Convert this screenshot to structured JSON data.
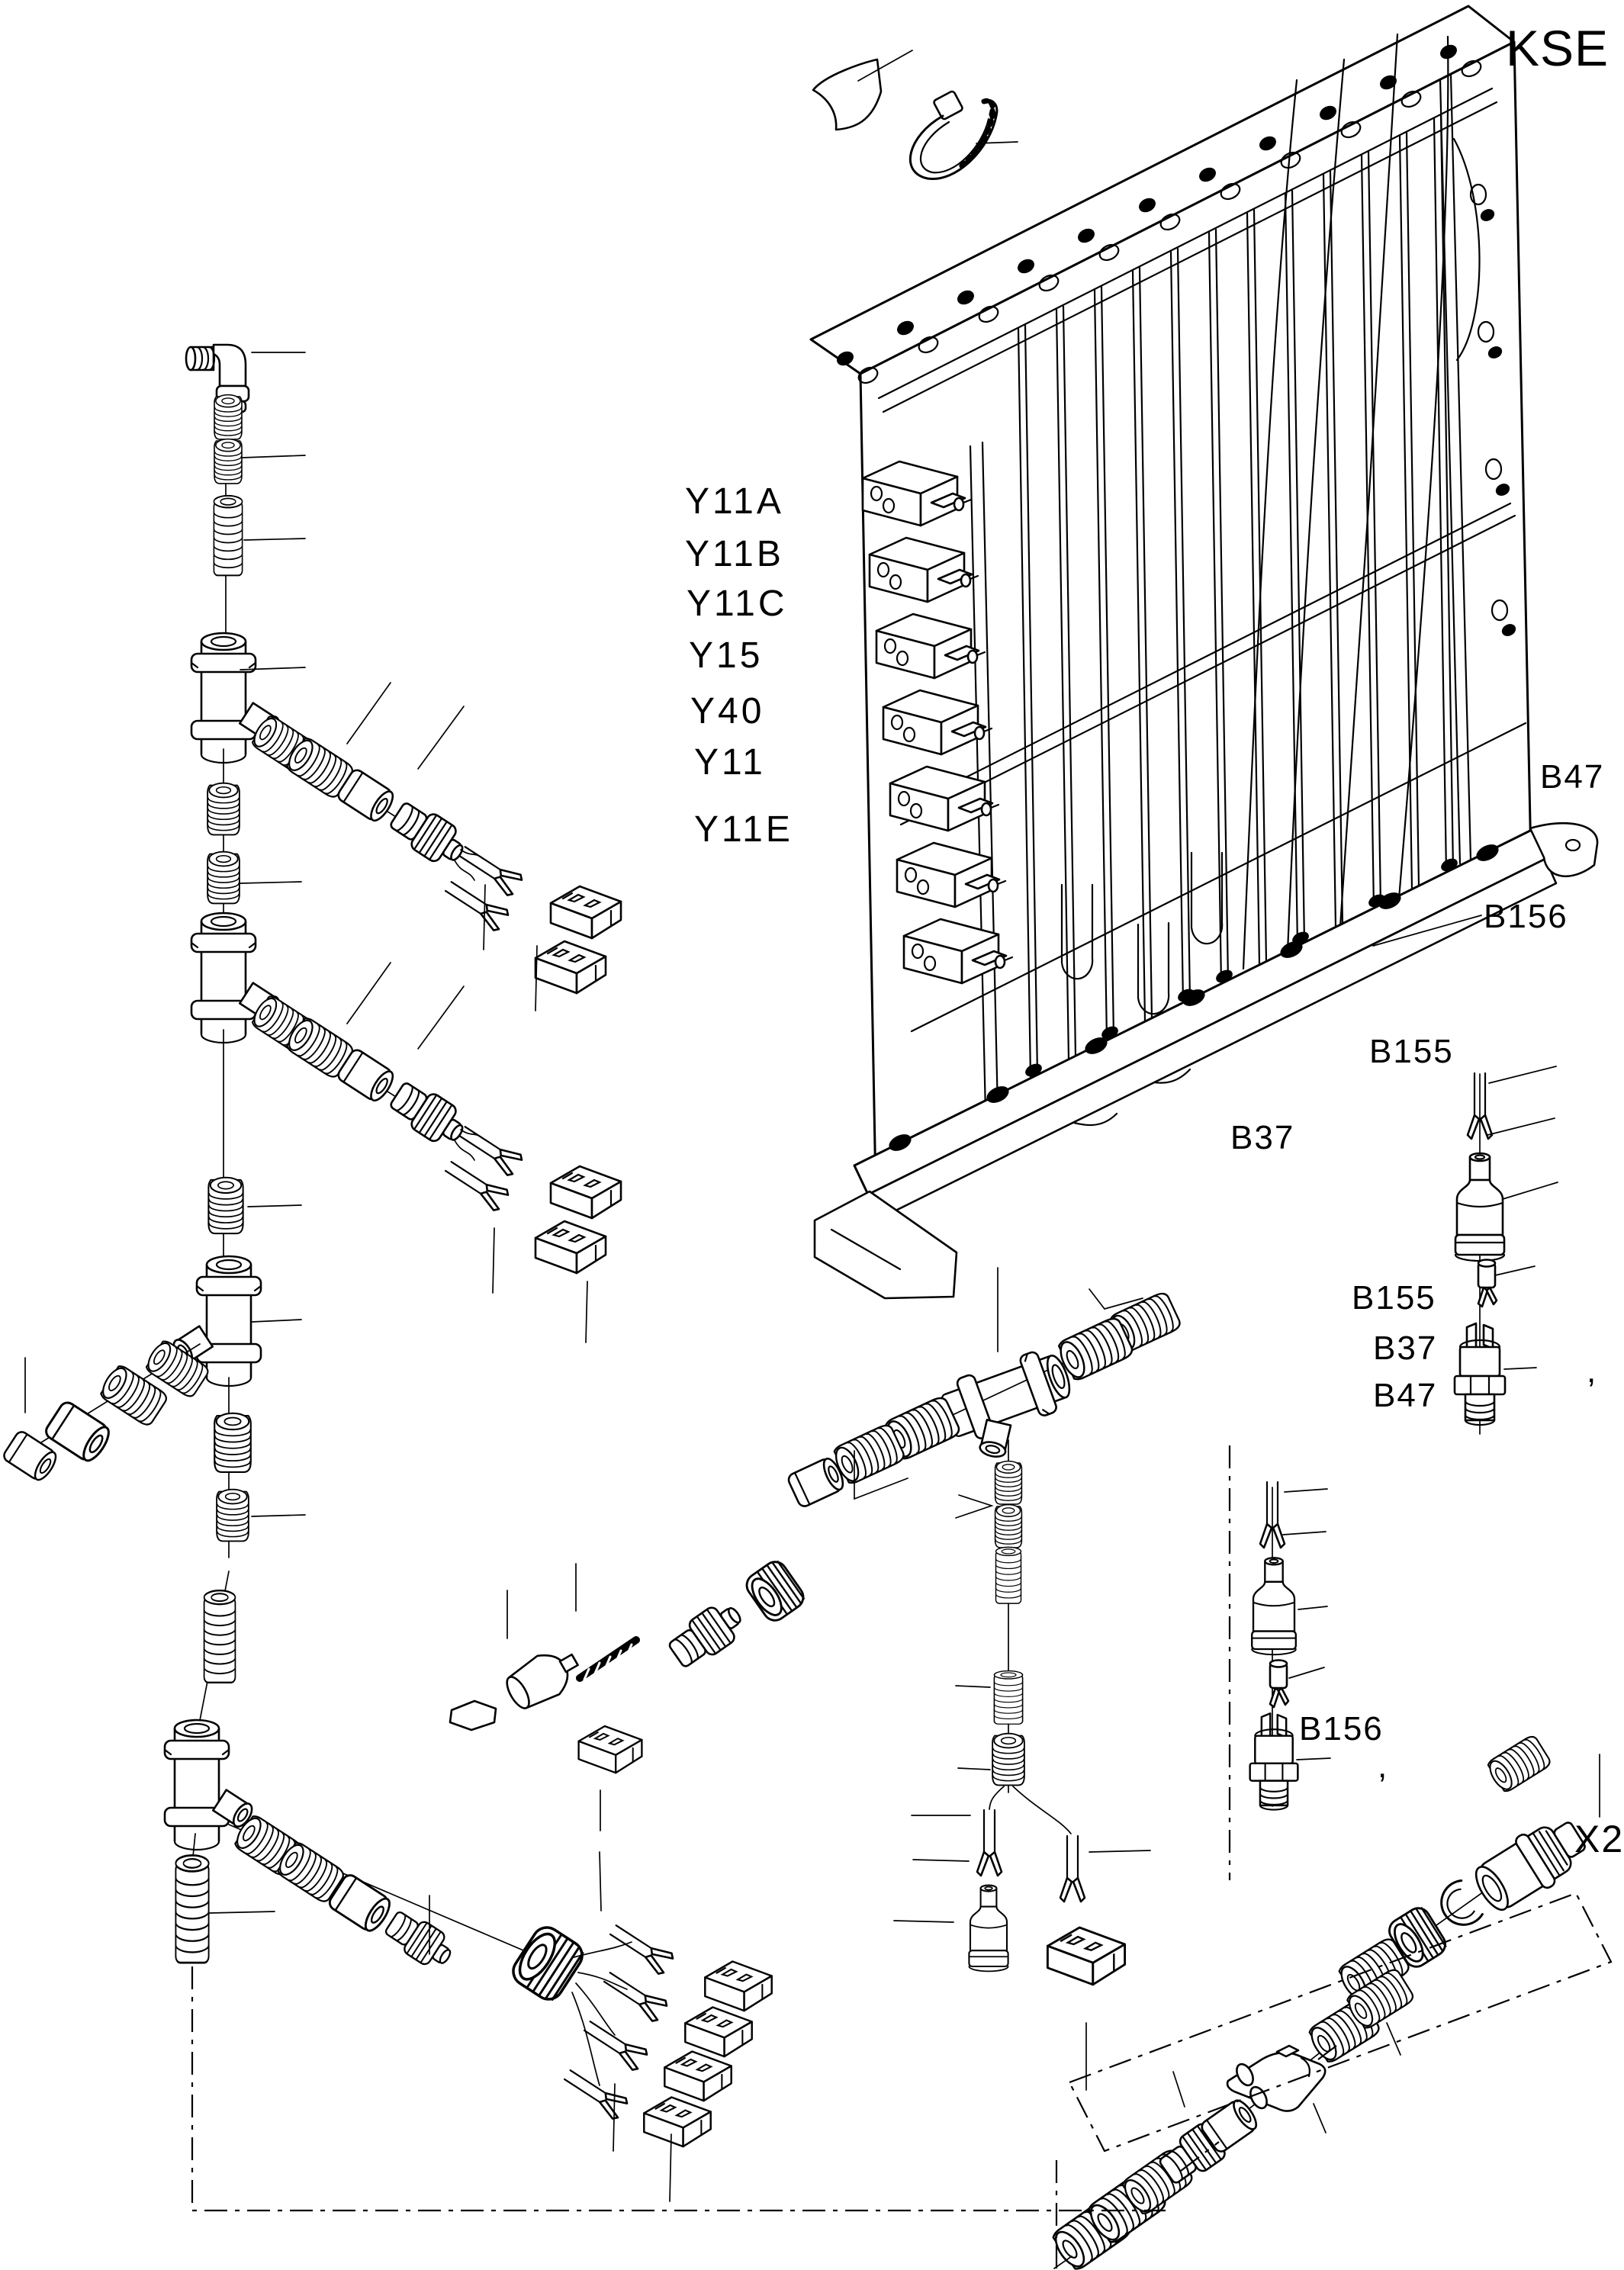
{
  "page": {
    "background": "#ffffff",
    "line_color": "#000000"
  },
  "labels": {
    "kse": "KSE",
    "solenoid": [
      "Y11A",
      "Y11B",
      "Y11C",
      "Y15",
      "Y40",
      "Y11",
      "Y11E"
    ],
    "b47_top": "B47",
    "b156_top": "B156",
    "b155_top": "B155",
    "b37_bottom": "B37",
    "switch_stack": [
      "B155",
      "B37",
      "B47"
    ],
    "b156_lower": "B156",
    "x2": "X2",
    "tick_mark": ","
  }
}
